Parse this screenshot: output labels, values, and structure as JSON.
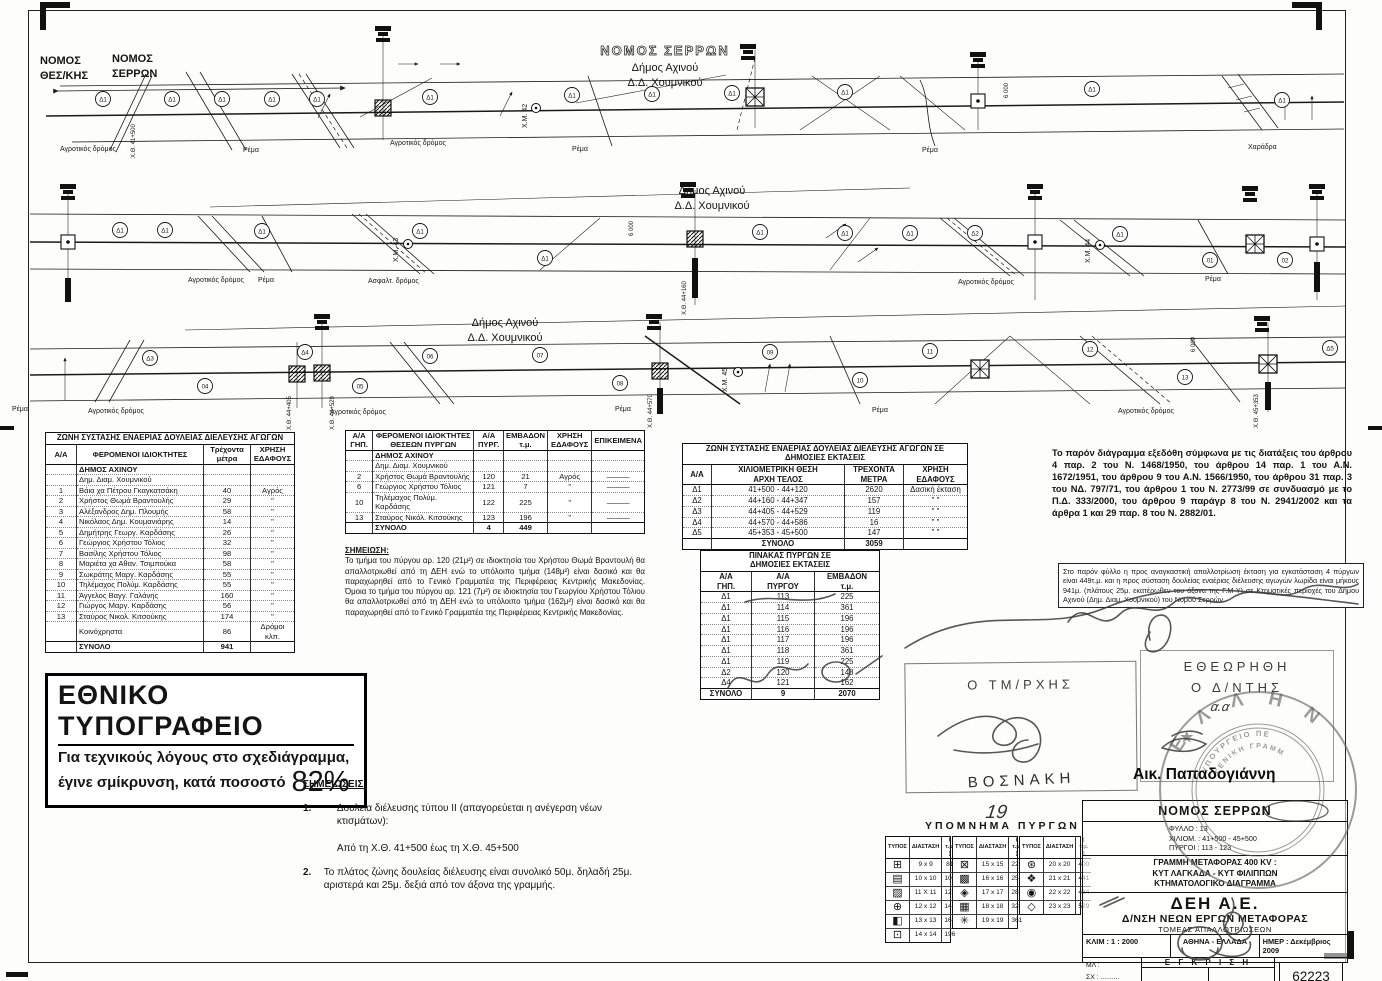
{
  "diagram": {
    "nomos_left_1": "ΝΟΜΟΣ",
    "nomos_left_2": "ΘΕΣ/ΚΗΣ",
    "nomos_right_1": "ΝΟΜΟΣ",
    "nomos_right_2": "ΣΕΡΡΩΝ",
    "nomos_serron": "ΝΟΜΟΣ ΣΕΡΡΩΝ",
    "dimos": "Δήμος Αχινού",
    "dd": "Δ.Δ. Χουμνικού",
    "circle_d1": "Δ1",
    "s2_circles": [
      "Δ1",
      "Δ1",
      "Δ1",
      "Δ1",
      "Δ1",
      "Δ1",
      "Δ1",
      "Δ1",
      "Δ2",
      "Δ1",
      "01",
      "02"
    ],
    "s3_circles": [
      "Δ3",
      "04",
      "Δ4",
      "05",
      "06",
      "07",
      "08",
      "09",
      "10",
      "11",
      "12",
      "13",
      "Δ5"
    ],
    "ground": {
      "agro": "Αγροτικός δρόμος",
      "rema": "Ρέμα",
      "asfalt": "Ασφαλτ. δρόμος",
      "haradra": "Χαράδρα"
    },
    "km": [
      "Χ.Μ. 42",
      "Χ.Μ. 43",
      "Χ.Μ. 44",
      "Χ.Μ. 45"
    ],
    "ch": [
      "Χ.Θ. 41+500",
      "Χ.Θ. 44+160",
      "Χ.Θ. 44+405",
      "Χ.Θ. 44+529",
      "Χ.Θ. 44+570",
      "Χ.Θ. 45+353"
    ],
    "span": "6 000"
  },
  "tables": {
    "zone_private": {
      "title": "ΖΩΝΗ ΣΥΣΤΑΣΗΣ ΕΝΑΕΡΙΑΣ ΔΟΥΛΕΙΑΣ ΔΙΕΛΕΥΣΗΣ ΑΓΩΓΩΝ",
      "headers": [
        "Α/Α",
        "ΦΕΡΟΜΕΝΟΙ   ΙΔΙΟΚΤΗΤΕΣ",
        "Τρέχοντα\nμέτρα",
        "ΧΡΗΣΗ\nΕΔΑΦΟΥΣ"
      ],
      "rows": [
        {
          "cls": "group",
          "cells": [
            "",
            "ΔΗΜΟΣ ΑΧΙΝΟΥ",
            "",
            ""
          ]
        },
        {
          "cls": "group2",
          "cells": [
            "",
            "Δημ. Διαμ. Χουμνικού",
            "",
            ""
          ]
        },
        {
          "cells": [
            "1",
            "Βάια χα Πέτρου Γκαγκατσάκη",
            "40",
            "Αγρός"
          ]
        },
        {
          "cells": [
            "2",
            "Χρήστος Θωμά Βραντουλής",
            "29",
            "\""
          ]
        },
        {
          "cells": [
            "3",
            "Αλέξανδρος Δημ. Πλουμής",
            "58",
            "\""
          ]
        },
        {
          "cells": [
            "4",
            "Νικόλαος Δημ. Κουμανιάρης",
            "14",
            "\""
          ]
        },
        {
          "cells": [
            "5",
            "Δημήτρης Γεωργ. Καρδάσης",
            "26",
            "\""
          ]
        },
        {
          "cells": [
            "6",
            "Γεώργιος Χρήστου Τόλιος",
            "32",
            "\""
          ]
        },
        {
          "cells": [
            "7",
            "Βασίλης Χρήστου Τόλιος",
            "98",
            "\""
          ]
        },
        {
          "cells": [
            "8",
            "Μαριέτα χα Αθαν. Τσιμπούκα",
            "58",
            "\""
          ]
        },
        {
          "cells": [
            "9",
            "Σωκράτης Μαργ. Καρδάσης",
            "55",
            "\""
          ]
        },
        {
          "cells": [
            "10",
            "Τηλέμαχος Πολύμ. Καρδάσης",
            "55",
            "\""
          ]
        },
        {
          "cells": [
            "11",
            "Άγγελος Βαγγ. Γαλάνης",
            "160",
            "\""
          ]
        },
        {
          "cells": [
            "12",
            "Γιώργος Μαργ. Καρδάσης",
            "56",
            "\""
          ]
        },
        {
          "cells": [
            "13",
            "Σταύρος Νικολ. Κιτσούκης",
            "174",
            "\""
          ]
        },
        {
          "cells": [
            "",
            "Κοινόχρηστα",
            "86",
            "Δρόμοι κλπ."
          ]
        },
        {
          "cls": "total",
          "cells": [
            "",
            "ΣΥΝΟΛΟ",
            "941",
            ""
          ]
        }
      ]
    },
    "owners_towers": {
      "headers": [
        "Α/Α\nΓΗΠ.",
        "ΦΕΡΟΜΕΝΟΙ ΙΔΙΟΚΤΗΤΕΣ\nΘΕΣΕΩΝ ΠΥΡΓΩΝ",
        "Α/Α\nΠΥΡΓ.",
        "ΕΜΒΑΔΟΝ\nτ.μ.",
        "ΧΡΗΣΗ\nΕΔΑΦΟΥΣ",
        "ΕΠΙΚΕΙΜΕΝΑ"
      ],
      "rows": [
        {
          "cls": "group",
          "cells": [
            "",
            "ΔΗΜΟΣ ΑΧΙΝΟΥ",
            "",
            "",
            "",
            ""
          ]
        },
        {
          "cls": "group2",
          "cells": [
            "",
            "Δημ. Διαμ. Χουμνικού",
            "",
            "",
            "",
            ""
          ]
        },
        {
          "cells": [
            "2",
            "Χρήστος Θωμά Βραντουλής",
            "120",
            "21",
            "Αγρός",
            "———"
          ]
        },
        {
          "cells": [
            "6",
            "Γεώργιος Χρήστου Τόλιος",
            "121",
            "7",
            "\"",
            "———"
          ]
        },
        {
          "cells": [
            "10",
            "Τηλέμαχος Πολύμ. Καρδάσης",
            "122",
            "225",
            "\"",
            "———"
          ]
        },
        {
          "cells": [
            "13",
            "Σταύρος Νικόλ. Κιτσούκης",
            "123",
            "196",
            "\"",
            "———"
          ]
        },
        {
          "cls": "total",
          "cells": [
            "",
            "ΣΥΝΟΛΟ",
            "4",
            "449",
            "",
            ""
          ]
        }
      ]
    },
    "zone_public": {
      "title": "ΖΩΝΗ ΣΥΣΤΑΣΗΣ ΕΝΑΕΡΙΑΣ ΔΟΥΛΕΙΑΣ ΔΙΕΛΕΥΣΗΣ ΑΓΩΓΩΝ ΣΕ\nΔΗΜΟΣΙΕΣ ΕΚΤΑΣΕΙΣ",
      "headers": [
        "Α/Α",
        "ΧΙΛΙΟΜΕΤΡΙΚΗ   ΘΕΣΗ\nΑΡΧΗ           ΤΕΛΟΣ",
        "ΤΡΕΧΟΝΤΑ\nΜΕΤΡΑ",
        "ΧΡΗΣΗ\nΕΔΑΦΟΥΣ"
      ],
      "rows": [
        {
          "cells": [
            "Δ1",
            "41+500   -   44+120",
            "2620",
            "Δασική έκταση"
          ]
        },
        {
          "cells": [
            "Δ2",
            "44+160   -   44+347",
            "157",
            "\"        \""
          ]
        },
        {
          "cells": [
            "Δ3",
            "44+405   -   44+529",
            "119",
            "\"        \""
          ]
        },
        {
          "cells": [
            "Δ4",
            "44+570   -   44+586",
            "16",
            "\"        \""
          ]
        },
        {
          "cells": [
            "Δ5",
            "45+353   -   45+500",
            "147",
            "\"        \""
          ]
        },
        {
          "cls": "total",
          "cells": [
            "",
            "ΣΥΝΟΛΟ",
            "3059",
            ""
          ]
        }
      ]
    },
    "towers_public": {
      "title": "ΠΙΝΑΚΑΣ ΠΥΡΓΩΝ ΣΕ\nΔΗΜΟΣΙΕΣ ΕΚΤΑΣΕΙΣ",
      "headers": [
        "Α/Α\nΓΗΠ.",
        "Α/Α\nΠΥΡΓΟΥ",
        "ΕΜΒΑΔΟΝ\nτ.μ."
      ],
      "rows": [
        {
          "cells": [
            "Δ1",
            "113",
            "225"
          ]
        },
        {
          "cells": [
            "Δ1",
            "114",
            "361"
          ]
        },
        {
          "cells": [
            "Δ1",
            "115",
            "196"
          ]
        },
        {
          "cells": [
            "Δ1",
            "116",
            "196"
          ]
        },
        {
          "cells": [
            "Δ1",
            "117",
            "196"
          ]
        },
        {
          "cells": [
            "Δ1",
            "118",
            "361"
          ]
        },
        {
          "cells": [
            "Δ1",
            "119",
            "225"
          ]
        },
        {
          "cells": [
            "Δ2",
            "120",
            "148"
          ]
        },
        {
          "cells": [
            "Δ4",
            "121",
            "162"
          ]
        },
        {
          "cls": "total",
          "cells": [
            "ΣΥΝΟΛΟ",
            "9",
            "2070"
          ]
        }
      ]
    },
    "legend": {
      "title": "ΥΠΟΜΝΗΜΑ  ΠΥΡΓΩΝ",
      "headers": [
        "ΤΥΠΟΣ",
        "ΔΙΑΣΤΑΣΗ",
        "( τ.μ. )"
      ],
      "groups": [
        [
          [
            "⊞",
            "9 x 9",
            "81"
          ],
          [
            "▤",
            "10 x 10",
            "100"
          ],
          [
            "▨",
            "11 X 11",
            "121"
          ],
          [
            "⊕",
            "12 x 12",
            "144"
          ],
          [
            "◧",
            "13 x 13",
            "169"
          ],
          [
            "⊡",
            "14 x 14",
            "196"
          ]
        ],
        [
          [
            "⊠",
            "15 x 15",
            "225"
          ],
          [
            "▩",
            "16 x 16",
            "256"
          ],
          [
            "◈",
            "17 x 17",
            "289"
          ],
          [
            "▦",
            "18 x 18",
            "324"
          ],
          [
            "✳",
            "19 x 19",
            "361"
          ]
        ],
        [
          [
            "⊛",
            "20 x 20",
            "400"
          ],
          [
            "❖",
            "21 x 21",
            "441"
          ],
          [
            "◉",
            "22 x 22",
            "484"
          ],
          [
            "◇",
            "23 x 23",
            "529"
          ]
        ]
      ]
    }
  },
  "note_single": {
    "heading": "ΣΗΜΕΙΩΣΗ:",
    "body": "Το τμήμα του πύργου αρ. 120 (21μ²) σε ιδιοκτησία του Χρήστου Θωμά Βραντουλή θα απαλλοτριωθεί από τη ΔΕΗ ενώ το υπόλοιπο τμήμα (148μ²) είναι δασικό και θα παραχωρηθεί από το Γενικό Γραμματέα της Περιφέρειας Κεντρικής Μακεδονίας. Όμοια το τμήμα του πύργου αρ. 121 (7μ²) σε ιδιοκτησία του  Γεωργίου Χρήστου Τόλιου θα απαλλοτριωθεί από τη ΔΕΗ ενώ το υπόλοιπο τμήμα (162μ²) είναι δασικό και θα παραχωρηθεί από το Γενικό Γραμματέα της Περιφέρειας Κεντρικής Μακεδονίας."
  },
  "legal": "Το παρόν διάγραμμα εξεδόθη σύμφωνα με τις διατάξεις του άρθρου 4 παρ. 2 του Ν. 1468/1950, του άρθρου 14 παρ. 1 του Α.Ν. 1672/1951, του άρθρου 9 του Α.Ν. 1566/1950, του άρθρου 31 παρ. 3 του ΝΔ. 797/71, του άρθρου 1 του Ν. 2773/99 σε συνδυασμό με το Π.Δ. 333/2000, του άρθρου 9 παράγρ 8 του Ν. 2941/2002 και τα άρθρα 1 και 29 παρ. 8 του Ν. 2882/01.",
  "handwritten_box": "Στο παρόν φύλλο η προς αναγκαστική απαλλοτρίωση έκταση για εγκατάσταση 4 πύργων είναι 449τ.μ. και η προς σύσταση δουλείας εναέριας διέλευσης αγωγών λωρίδα είναι μήκους 941μ. (πλάτους 25μ. εκατέρωθεν του άξονα της Γ.Μ-Υ) σε Κτηματικές περιοχές του Δήμου Αχινού (Δημ. Διαμ. Χουμνικού) του Νομού Σερρών.",
  "national_print": {
    "line1": "ΕΘΝΙΚΟ ΤΥΠΟΓΡΑΦΕΙΟ",
    "line2": "Για τεχνικούς λόγους στο σχεδιάγραμμα,",
    "line3": "έγινε σμίκρυνση, κατά ποσοστό",
    "pct": "82%"
  },
  "notes": {
    "heading": "ΣΗΜΕΙΩΣΕΙΣ:",
    "item1_no": "1.",
    "item1a": "Δουλεία διέλευσης τύπου ΙΙ (απαγορεύεται η ανέγερση νέων κτισμάτων):",
    "item1b": "Από τη Χ.Θ. 41+500 έως τη Χ.Θ. 45+500",
    "item2_no": "2.",
    "item2": "Το πλάτος ζώνης δουλείας διέλευσης είναι συνολικό 50μ. δηλαδή 25μ. αριστερά και 25μ. δεξιά από τον άξονα της γραμμής."
  },
  "signatures": {
    "tmrxis": "Ο ΤΜ/ΡΧΗΣ",
    "vosnaki": "ΒΟΣΝΑΚΗ",
    "etheorithi": "ΕΘΕΩΡΗΘΗ",
    "dntis": "Ο Δ/ΝΤΗΣ",
    "aa": "α.α",
    "papadogianni": "Αικ. Παπαδογιάννη"
  },
  "stamp": {
    "arc_letters": "Ε Λ Λ Η Ν",
    "inner_top": "ΥΠΟΥΡΓΕΙΟ ΠΕ",
    "inner_mid": "ΓΕΝΙΚΗ ΓΡΑΜΜ",
    "star": "★"
  },
  "title_block": {
    "handwritten_no": "19",
    "nomos": "ΝΟΜΟΣ ΣΕΡΡΩΝ",
    "fyllo": "ΦΥΛΛΟ : 13",
    "xiliom": "ΧΙΛΙΟΜ. : 41+500 - 45+500",
    "pyrgoi": "ΠΥΡΓΟΙ : 113 - 123",
    "line1": "ΓΡΑΜΜΗ ΜΕΤΑΦΟΡΑΣ 400 KV :",
    "line2": "ΚΥΤ ΛΑΓΚΑΔΑ - ΚΥΤ ΦΙΛΙΠΠΩΝ",
    "line3": "ΚΤΗΜΑΤΟΛΟΓΙΚΟ ΔΙΑΓΡΑΜΜΑ",
    "company": "ΔΕΗ Α.Ε.",
    "division": "Δ/ΝΣΗ ΝΕΩΝ ΕΡΓΩΝ ΜΕΤΑΦΟΡΑΣ",
    "sector": "ΤΟΜΕΑΣ ΑΠΑΛΛΟΤΡΙΩΣΕΩΝ",
    "klim": "ΚΛΙΜ :  1 : 2000",
    "city": "ΑΘΗΝΑ - ΕΛΛΑΔΑ",
    "imer": "ΗΜΕΡ : Δεκέμβριος 2009",
    "ml": "ΜΛ :",
    "sx": "ΣΧ : ..........",
    "el": "ΕΛ : ..........",
    "egkrisi": "Ε Γ Κ Ρ Ι Σ Η",
    "number": "62223",
    "sheet_info": "ΦΥΛΛΟ 13 ΑΠΟ 33"
  }
}
